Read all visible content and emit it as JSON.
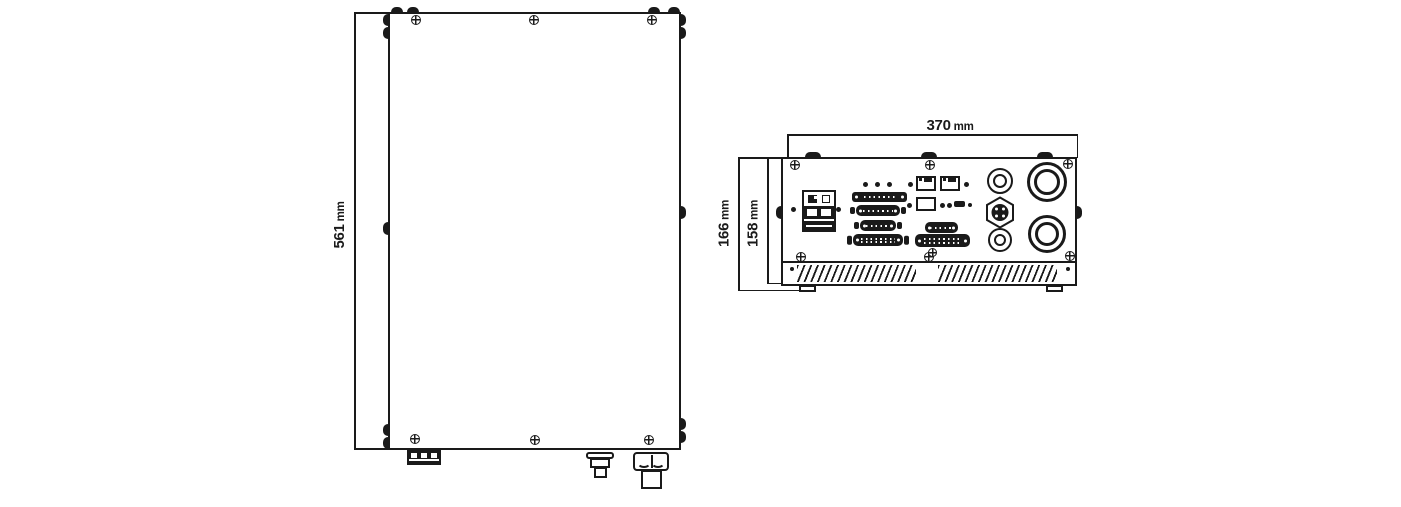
{
  "figure": {
    "kind": "mechanical dimension drawing, two views of laser source chassis",
    "line_color": "#1a1a1a",
    "background_color": "#ffffff"
  },
  "dims": {
    "left_height": {
      "value": "561",
      "unit": "mm"
    },
    "rear_width": {
      "value": "370",
      "unit": "mm"
    },
    "rear_outer_height": {
      "value": "166",
      "unit": "mm"
    },
    "rear_panel_height": {
      "value": "158",
      "unit": "mm"
    }
  }
}
